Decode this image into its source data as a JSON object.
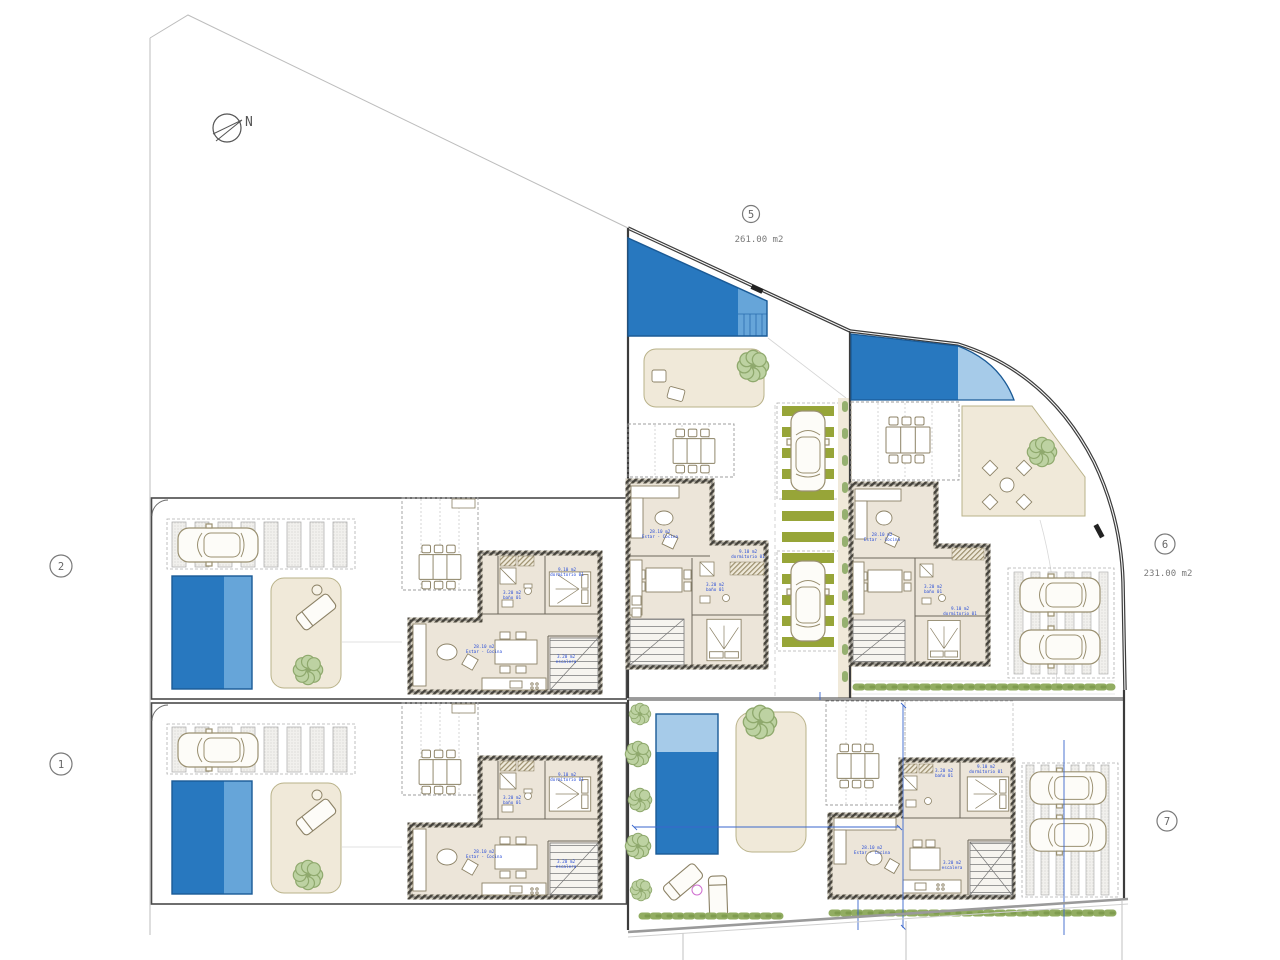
{
  "compass": {
    "label": "N"
  },
  "plots": {
    "p1": {
      "number": "1"
    },
    "p2": {
      "number": "2"
    },
    "p5": {
      "number": "5",
      "area": "261.00 m2"
    },
    "p6": {
      "number": "6",
      "area": "231.00 m2"
    },
    "p7": {
      "number": "7"
    }
  },
  "room_labels": {
    "living_area": "28.10 m2",
    "living_name": "Estar - Cocina",
    "bedroom_area": "9.10 m2",
    "bedroom_name": "dormitorio 01",
    "bath_area": "3.20 m2",
    "bath_name": "baño 01",
    "stairs_area": "3.20 m2",
    "stairs_name": "escalera"
  },
  "colors": {
    "pool_dark": "#2878bf",
    "pool_mid": "#66a5d9",
    "pool_light": "#a6cbe9",
    "terrace": "#f0e9d9",
    "olive": "#97a538",
    "hedge_a": "#92ad62",
    "hedge_b": "#7f9c4f",
    "label_blue": "#2b4fd7",
    "dim_blue": "#3a66cc",
    "wall": "#4a463c"
  }
}
